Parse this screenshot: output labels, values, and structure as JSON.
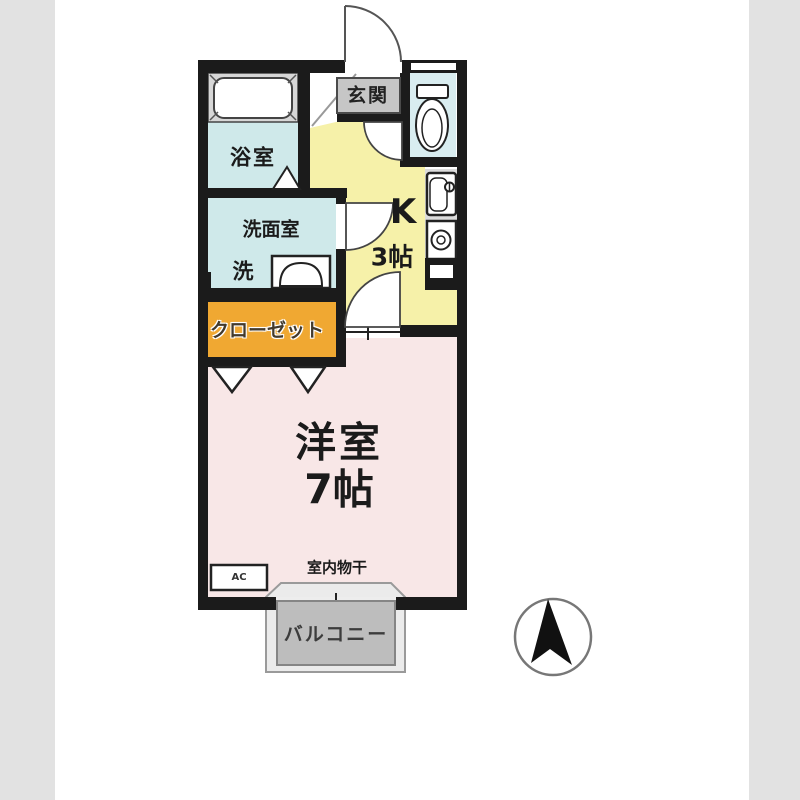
{
  "background": {
    "strip_color": "#e2e2e2",
    "paper_color": "#ffffff"
  },
  "floorplan": {
    "entrance": {
      "label": "玄関"
    },
    "bathroom": {
      "label": "浴室"
    },
    "washroom": {
      "label": "洗面室",
      "washer_label": "洗"
    },
    "closet": {
      "label": "クローゼット"
    },
    "kitchen": {
      "label": "K",
      "size": "3帖"
    },
    "western_room": {
      "label": "洋室",
      "size": "7帖"
    },
    "indoor_drying": {
      "label": "室内物干"
    },
    "ac_unit": {
      "label": "AC"
    },
    "balcony": {
      "label": "バルコニー"
    },
    "compass": {
      "type": "north-arrow"
    },
    "colors": {
      "wall": "#1b1b1b",
      "kitchen_floor": "#f6f1a9",
      "western_room_floor": "#f8e7e7",
      "wet_area_floor": "#cfe9ea",
      "toilet_floor": "#d9edf0",
      "closet": "#f0a832",
      "balcony": "#bdbdbd",
      "label_box": "#c6c6c6"
    }
  }
}
